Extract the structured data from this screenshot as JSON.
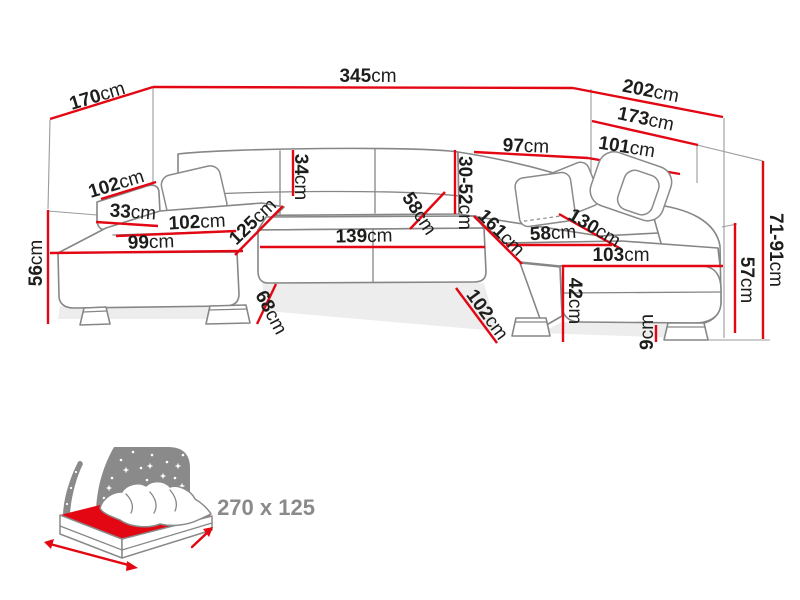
{
  "colors": {
    "dimension_red": "#e30613",
    "outline_gray": "#868686",
    "icon_gray": "#8a8a8a",
    "label_black": "#1d1d1b"
  },
  "dims": {
    "d170": {
      "num": "170",
      "unit": "cm"
    },
    "d345": {
      "num": "345",
      "unit": "cm"
    },
    "d202": {
      "num": "202",
      "unit": "cm"
    },
    "d173": {
      "num": "173",
      "unit": "cm"
    },
    "d101": {
      "num": "101",
      "unit": "cm"
    },
    "d97": {
      "num": "97",
      "unit": "cm"
    },
    "d102_armrest": {
      "num": "102",
      "unit": "cm"
    },
    "d33": {
      "num": "33",
      "unit": "cm"
    },
    "d102_seat": {
      "num": "102",
      "unit": "cm"
    },
    "d99": {
      "num": "99",
      "unit": "cm"
    },
    "d125": {
      "num": "125",
      "unit": "cm"
    },
    "d34": {
      "num": "34",
      "unit": "cm"
    },
    "d58_mid": {
      "num": "58",
      "unit": "cm"
    },
    "d139": {
      "num": "139",
      "unit": "cm"
    },
    "d30_52": {
      "num": "30-52",
      "unit": "cm"
    },
    "d161": {
      "num": "161",
      "unit": "cm"
    },
    "d58_right": {
      "num": "58",
      "unit": "cm"
    },
    "d130": {
      "num": "130",
      "unit": "cm"
    },
    "d103": {
      "num": "103",
      "unit": "cm"
    },
    "d42": {
      "num": "42",
      "unit": "cm"
    },
    "d57": {
      "num": "57",
      "unit": "cm"
    },
    "d71_91": {
      "num": "71-91",
      "unit": "cm"
    },
    "d56": {
      "num": "56",
      "unit": "cm"
    },
    "d68": {
      "num": "68",
      "unit": "cm"
    },
    "d102_bottom": {
      "num": "102",
      "unit": "cm"
    },
    "d9": {
      "num": "9",
      "unit": "cm"
    }
  },
  "sleep_function": {
    "size_label": "270 x 125"
  }
}
